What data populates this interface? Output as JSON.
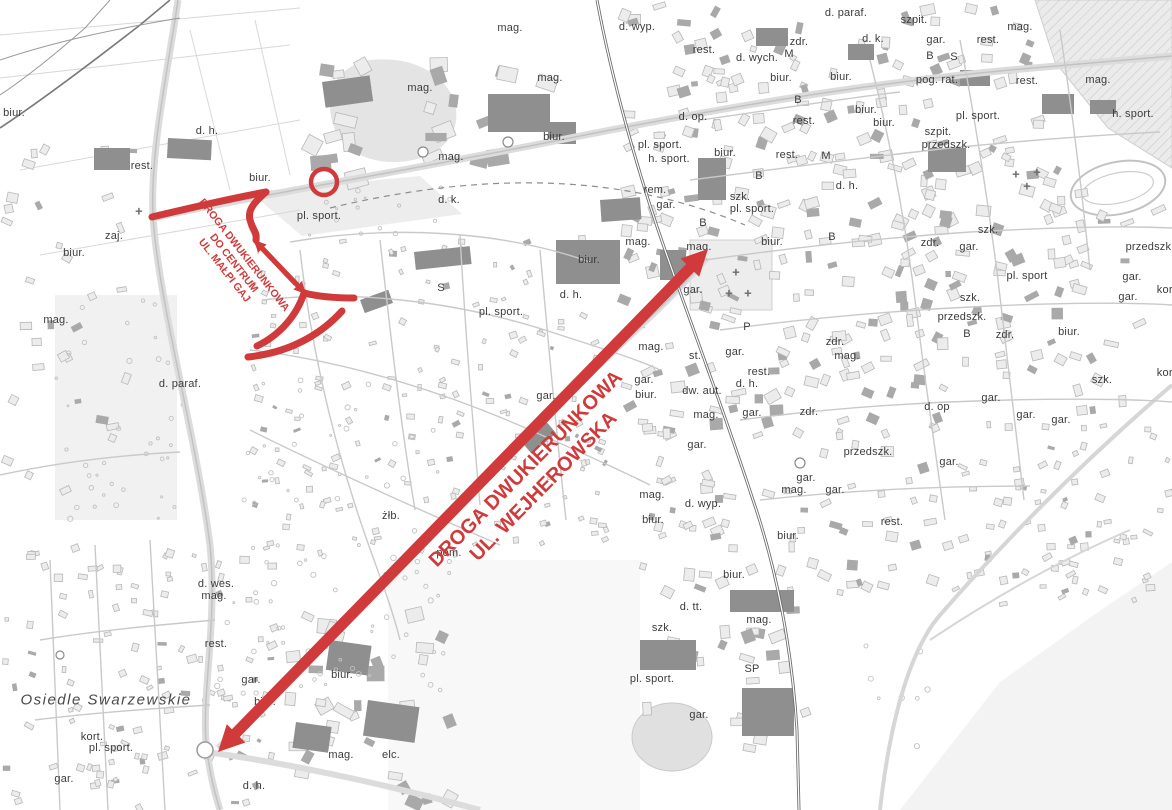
{
  "annotation_color": "#d13a3a",
  "main_route": {
    "line1": "DROGA DWUKIERUNKOWA",
    "line2": "UL. WEJHEROWSKA"
  },
  "secondary_route": {
    "line1": "DROGA DWUKIERUNKOWA",
    "line2": "DO CENTRUM",
    "line3": "UL. MAŁPI GAJ"
  },
  "map_labels": [
    {
      "t": "d. h.",
      "x": 207,
      "y": 131
    },
    {
      "t": "rest.",
      "x": 142,
      "y": 166
    },
    {
      "t": "biur.",
      "x": 260,
      "y": 178
    },
    {
      "t": "zaj.",
      "x": 114,
      "y": 236
    },
    {
      "t": "biur.",
      "x": 14,
      "y": 113
    },
    {
      "t": "biur.",
      "x": 74,
      "y": 253
    },
    {
      "t": "mag.",
      "x": 56,
      "y": 320
    },
    {
      "t": "d. paraf.",
      "x": 180,
      "y": 384
    },
    {
      "t": "mag.",
      "x": 420,
      "y": 88
    },
    {
      "t": "mag.",
      "x": 510,
      "y": 28
    },
    {
      "t": "mag.",
      "x": 550,
      "y": 78
    },
    {
      "t": "biur.",
      "x": 554,
      "y": 137
    },
    {
      "t": "mag.",
      "x": 451,
      "y": 157
    },
    {
      "t": "d. k.",
      "x": 449,
      "y": 200
    },
    {
      "t": "pl. sport.",
      "x": 319,
      "y": 216
    },
    {
      "t": "S",
      "x": 441,
      "y": 288
    },
    {
      "t": "pl. sport.",
      "x": 501,
      "y": 312
    },
    {
      "t": "d. h.",
      "x": 571,
      "y": 295
    },
    {
      "t": "biur.",
      "x": 589,
      "y": 260
    },
    {
      "t": "gar.",
      "x": 546,
      "y": 396
    },
    {
      "t": "żłb.",
      "x": 391,
      "y": 516
    },
    {
      "t": "pom.",
      "x": 449,
      "y": 553
    },
    {
      "t": "biur.",
      "x": 342,
      "y": 675
    },
    {
      "t": "mag.",
      "x": 341,
      "y": 755
    },
    {
      "t": "elc.",
      "x": 391,
      "y": 755
    },
    {
      "t": "d. wyp.",
      "x": 637,
      "y": 27
    },
    {
      "t": "rest.",
      "x": 704,
      "y": 50
    },
    {
      "t": "d. wych.",
      "x": 757,
      "y": 58
    },
    {
      "t": "zdr.",
      "x": 799,
      "y": 42
    },
    {
      "t": "M",
      "x": 789,
      "y": 54
    },
    {
      "t": "d. paraf.",
      "x": 846,
      "y": 13
    },
    {
      "t": "d. k.",
      "x": 873,
      "y": 39
    },
    {
      "t": "biur.",
      "x": 781,
      "y": 78
    },
    {
      "t": "biur.",
      "x": 841,
      "y": 77
    },
    {
      "t": "B",
      "x": 798,
      "y": 100
    },
    {
      "t": "rest.",
      "x": 804,
      "y": 121
    },
    {
      "t": "biur.",
      "x": 866,
      "y": 110
    },
    {
      "t": "biur.",
      "x": 884,
      "y": 123
    },
    {
      "t": "d. op.",
      "x": 693,
      "y": 117
    },
    {
      "t": "pl. sport.",
      "x": 660,
      "y": 145
    },
    {
      "t": "h. sport.",
      "x": 669,
      "y": 159
    },
    {
      "t": "biur.",
      "x": 725,
      "y": 153
    },
    {
      "t": "rest.",
      "x": 787,
      "y": 155
    },
    {
      "t": "M",
      "x": 826,
      "y": 156
    },
    {
      "t": "rem.",
      "x": 655,
      "y": 190
    },
    {
      "t": "gar.",
      "x": 666,
      "y": 205
    },
    {
      "t": "B",
      "x": 759,
      "y": 176
    },
    {
      "t": "d. h.",
      "x": 847,
      "y": 186
    },
    {
      "t": "szk.",
      "x": 740,
      "y": 197
    },
    {
      "t": "pl. sport.",
      "x": 752,
      "y": 209
    },
    {
      "t": "B",
      "x": 703,
      "y": 223
    },
    {
      "t": "biur.",
      "x": 772,
      "y": 242
    },
    {
      "t": "B",
      "x": 832,
      "y": 237
    },
    {
      "t": "mag.",
      "x": 638,
      "y": 242
    },
    {
      "t": "mag.",
      "x": 699,
      "y": 247
    },
    {
      "t": "gar.",
      "x": 693,
      "y": 290
    },
    {
      "t": "P",
      "x": 747,
      "y": 327
    },
    {
      "t": "mag.",
      "x": 651,
      "y": 347
    },
    {
      "t": "st.",
      "x": 695,
      "y": 356
    },
    {
      "t": "gar.",
      "x": 735,
      "y": 352
    },
    {
      "t": "gar.",
      "x": 644,
      "y": 380
    },
    {
      "t": "biur.",
      "x": 646,
      "y": 395
    },
    {
      "t": "rest.",
      "x": 759,
      "y": 372
    },
    {
      "t": "d. h.",
      "x": 747,
      "y": 384
    },
    {
      "t": "dw. aut.",
      "x": 702,
      "y": 391
    },
    {
      "t": "zdr.",
      "x": 835,
      "y": 342
    },
    {
      "t": "mag.",
      "x": 847,
      "y": 356
    },
    {
      "t": "szpit.",
      "x": 914,
      "y": 20
    },
    {
      "t": "gar.",
      "x": 936,
      "y": 40
    },
    {
      "t": "B",
      "x": 930,
      "y": 56
    },
    {
      "t": "S",
      "x": 954,
      "y": 57
    },
    {
      "t": "mag.",
      "x": 1020,
      "y": 27
    },
    {
      "t": "rest.",
      "x": 988,
      "y": 40
    },
    {
      "t": "pog. rat.",
      "x": 937,
      "y": 80
    },
    {
      "t": "rest.",
      "x": 1027,
      "y": 81
    },
    {
      "t": "mag.",
      "x": 1098,
      "y": 80
    },
    {
      "t": "pl. sport.",
      "x": 978,
      "y": 116
    },
    {
      "t": "h. sport.",
      "x": 1133,
      "y": 114
    },
    {
      "t": "szpit.",
      "x": 938,
      "y": 132
    },
    {
      "t": "przedszk.",
      "x": 946,
      "y": 145
    },
    {
      "t": "szk.",
      "x": 988,
      "y": 230
    },
    {
      "t": "zdr.",
      "x": 930,
      "y": 243
    },
    {
      "t": "gar.",
      "x": 969,
      "y": 247
    },
    {
      "t": "przedszk.",
      "x": 1150,
      "y": 247
    },
    {
      "t": "pl. sport",
      "x": 1027,
      "y": 276
    },
    {
      "t": "gar.",
      "x": 1132,
      "y": 277
    },
    {
      "t": "gar.",
      "x": 1128,
      "y": 297
    },
    {
      "t": "kort.",
      "x": 1168,
      "y": 290
    },
    {
      "t": "szk.",
      "x": 970,
      "y": 298
    },
    {
      "t": "przedszk.",
      "x": 962,
      "y": 317
    },
    {
      "t": "B",
      "x": 967,
      "y": 334
    },
    {
      "t": "zdr.",
      "x": 1005,
      "y": 335
    },
    {
      "t": "biur.",
      "x": 1069,
      "y": 332
    },
    {
      "t": "szk.",
      "x": 1102,
      "y": 380
    },
    {
      "t": "kort.",
      "x": 1168,
      "y": 373
    },
    {
      "t": "gar.",
      "x": 991,
      "y": 398
    },
    {
      "t": "d. op",
      "x": 937,
      "y": 407
    },
    {
      "t": "gar.",
      "x": 1026,
      "y": 415
    },
    {
      "t": "gar.",
      "x": 1061,
      "y": 420
    },
    {
      "t": "gar.",
      "x": 949,
      "y": 462
    },
    {
      "t": "mag.",
      "x": 706,
      "y": 415
    },
    {
      "t": "gar.",
      "x": 752,
      "y": 413
    },
    {
      "t": "zdr.",
      "x": 809,
      "y": 412
    },
    {
      "t": "gar.",
      "x": 697,
      "y": 445
    },
    {
      "t": "przedszk.",
      "x": 868,
      "y": 452
    },
    {
      "t": "gar.",
      "x": 806,
      "y": 478
    },
    {
      "t": "mag.",
      "x": 794,
      "y": 490
    },
    {
      "t": "gar.",
      "x": 835,
      "y": 490
    },
    {
      "t": "mag.",
      "x": 652,
      "y": 495
    },
    {
      "t": "d. wyp.",
      "x": 703,
      "y": 504
    },
    {
      "t": "biur.",
      "x": 653,
      "y": 520
    },
    {
      "t": "rest.",
      "x": 892,
      "y": 522
    },
    {
      "t": "biur.",
      "x": 788,
      "y": 536
    },
    {
      "t": "biur.",
      "x": 734,
      "y": 575
    },
    {
      "t": "d. tt.",
      "x": 691,
      "y": 607
    },
    {
      "t": "szk.",
      "x": 662,
      "y": 628
    },
    {
      "t": "mag.",
      "x": 759,
      "y": 620
    },
    {
      "t": "SP",
      "x": 752,
      "y": 669
    },
    {
      "t": "pl. sport.",
      "x": 652,
      "y": 679
    },
    {
      "t": "gar.",
      "x": 699,
      "y": 715
    },
    {
      "t": "d. wes.",
      "x": 216,
      "y": 584
    },
    {
      "t": "mag.",
      "x": 214,
      "y": 596
    },
    {
      "t": "rest.",
      "x": 216,
      "y": 644
    },
    {
      "t": "gar.",
      "x": 251,
      "y": 680
    },
    {
      "t": "biur.",
      "x": 265,
      "y": 702
    },
    {
      "t": "kort.",
      "x": 92,
      "y": 737
    },
    {
      "t": "pl. sport.",
      "x": 111,
      "y": 748
    },
    {
      "t": "gar.",
      "x": 64,
      "y": 779
    },
    {
      "t": "d. h.",
      "x": 254,
      "y": 786
    },
    {
      "t": "Osiedle Swarzewskie",
      "x": 106,
      "y": 700,
      "style": "district"
    },
    {
      "t": "+",
      "x": 139,
      "y": 211,
      "style": "sym"
    },
    {
      "t": "+",
      "x": 736,
      "y": 272,
      "style": "sym"
    },
    {
      "t": "+",
      "x": 729,
      "y": 293,
      "style": "sym"
    },
    {
      "t": "+",
      "x": 748,
      "y": 293,
      "style": "sym"
    },
    {
      "t": "+",
      "x": 1016,
      "y": 174,
      "style": "sym"
    },
    {
      "t": "+",
      "x": 1037,
      "y": 172,
      "style": "sym"
    },
    {
      "t": "+",
      "x": 1027,
      "y": 186,
      "style": "sym"
    }
  ]
}
